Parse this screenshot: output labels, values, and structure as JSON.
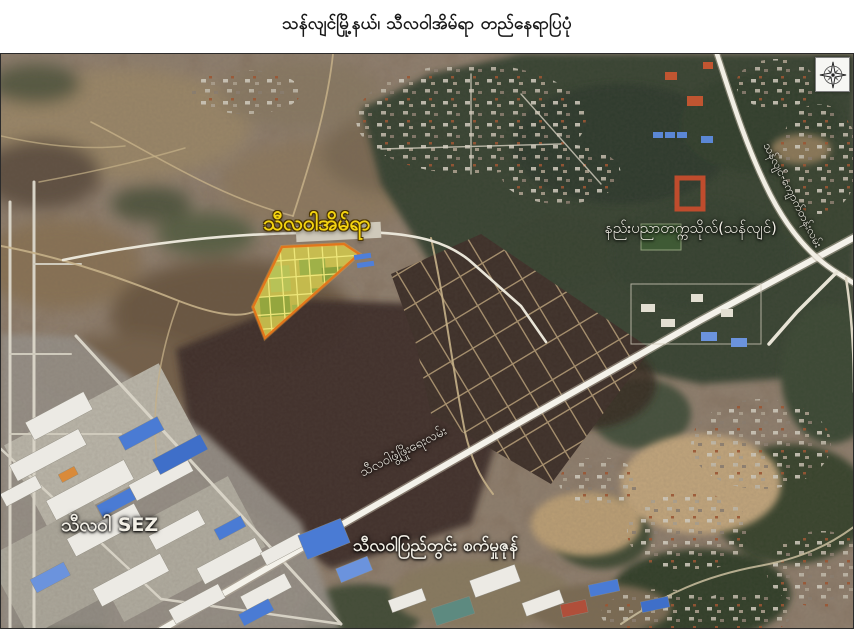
{
  "title": "သန်လျင်မြို့နယ်၊ သီလဝါအိမ်ရာ တည်နေရာပြပုံ",
  "map": {
    "labels": {
      "housing": "သီလဝါအိမ်ရာ",
      "university": "နည်းပညာတက္ကသိုလ်(သန်လျင်)",
      "kyauktan_road": "သန်လျင်-ကျောက်တန်းလမ်း",
      "development_road": "သီလဝါဖွံ့ဖြိုးရေးလမ်း",
      "sez": "သီလဝါ SEZ",
      "industrial_zone": "သီလဝါပြည်တွင်း စက်မှုဇုန်"
    },
    "icons": {
      "compass": "compass-rose"
    },
    "colors": {
      "highlight_fill": "#ccc24e",
      "highlight_border": "#e2761b",
      "label_yellow": "#f4d411",
      "label_white": "#f2efe6",
      "road_white": "#f4f2ea"
    }
  }
}
